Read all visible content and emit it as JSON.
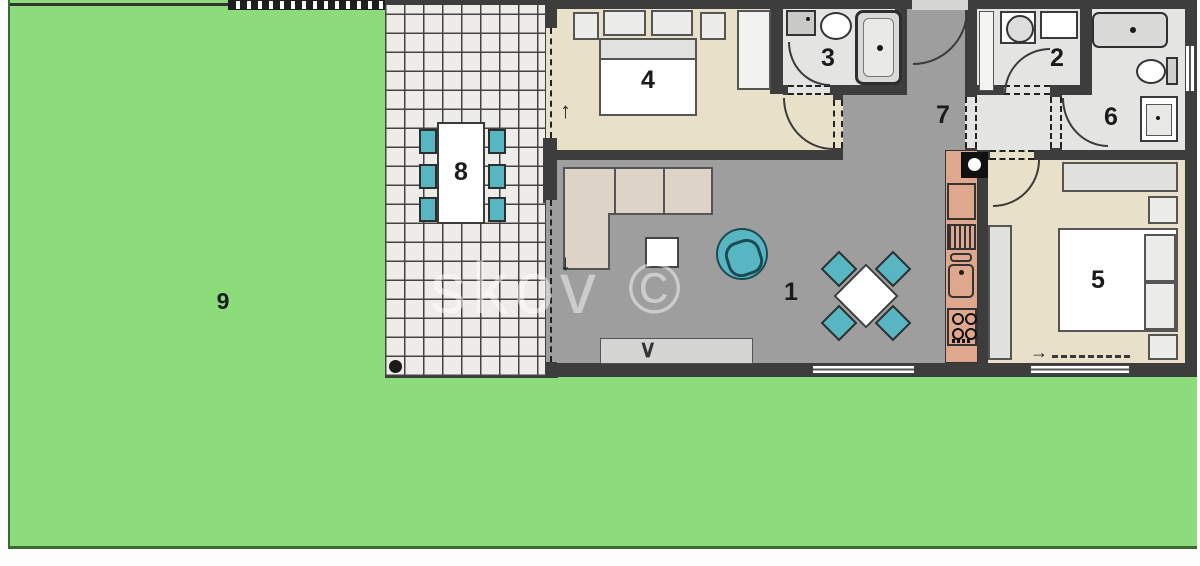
{
  "title": "apartment-floor-plan",
  "watermark": "skov ©",
  "room_labels": {
    "living": "1",
    "utility": "2",
    "bath_small": "3",
    "bedroom_left": "4",
    "bedroom_right": "5",
    "bath_main": "6",
    "hallway": "7",
    "terrace_table": "8",
    "garden": "9"
  },
  "marks": {
    "arrow_up": "↑",
    "arrow_down": "↓",
    "arrow_right": "→",
    "tv_chevron": "∨"
  },
  "colors": {
    "grass": "#8ddc7c",
    "grass_border": "#3a6b35",
    "wall": "#3d3d3d",
    "tile": "#edece8",
    "floor-gray": "#9e9e9e",
    "floor-beige": "#e9e0c9",
    "floor-bath": "#e4e4e2",
    "teal": "#57b6c1",
    "kitchen": "#dfa78e",
    "sofa": "#ddd3c6"
  }
}
